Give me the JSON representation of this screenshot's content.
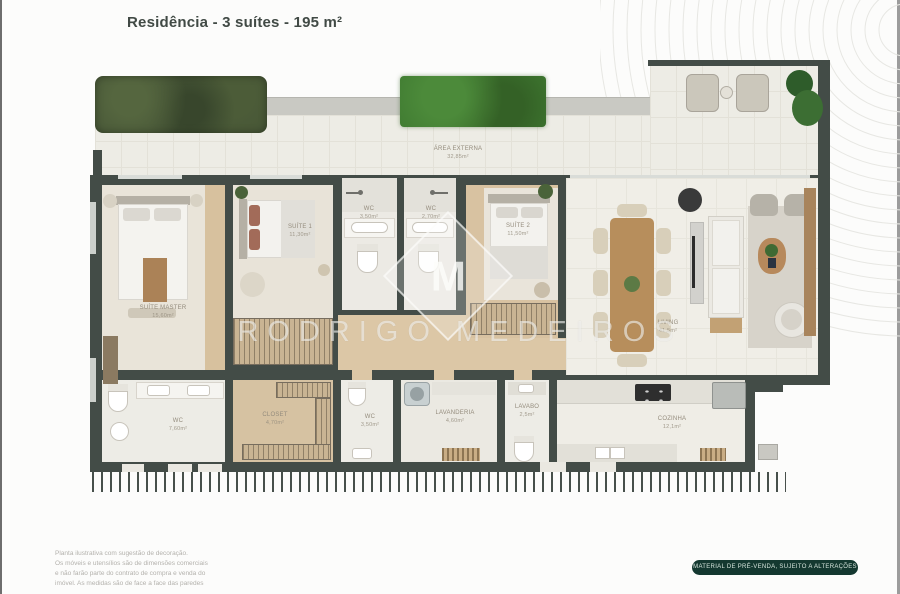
{
  "header": {
    "title": "Residência - 3 suítes - 195 m²"
  },
  "watermark": {
    "brand": "RODRIGO MEDEIROS",
    "monogram": "M"
  },
  "terrace": {
    "label": "ÁREA EXTERNA",
    "area": "32,85m²"
  },
  "rooms": {
    "suite_master": {
      "label": "SUÍTE MASTER",
      "area": "15,60m²"
    },
    "suite_1": {
      "label": "SUÍTE 1",
      "area": "11,30m²"
    },
    "wc_1": {
      "label": "WC",
      "area": "3,50m²"
    },
    "wc_2": {
      "label": "WC",
      "area": "2,70m²"
    },
    "suite_2": {
      "label": "SUÍTE 2",
      "area": "11,50m²"
    },
    "living": {
      "label": "LIVING",
      "area": "41,5m²"
    },
    "wc_master": {
      "label": "WC",
      "area": "7,60m²"
    },
    "closet": {
      "label": "CLOSET",
      "area": "4,70m²"
    },
    "wc_3": {
      "label": "WC",
      "area": "3,50m²"
    },
    "lavanderia": {
      "label": "LAVANDERIA",
      "area": "4,60m²"
    },
    "lavabo": {
      "label": "LAVABO",
      "area": "2,5m²"
    },
    "cozinha": {
      "label": "COZINHA",
      "area": "12,1m²"
    }
  },
  "footer": {
    "disclaimer_lines": [
      "Planta ilustrativa com sugestão de decoração.",
      "Os móveis e utensílios são de dimensões comerciais",
      "e não farão parte do contrato de compra e venda do",
      "imóvel. As medidas são de face a face das paredes"
    ],
    "badge": "MATERIAL DE PRÉ-VENDA, SUJEITO A ALTERAÇÕES"
  },
  "colors": {
    "wall": "#434c47",
    "badge_bg": "#143830",
    "wood": "#d7c19e",
    "grass": "#3f7a31"
  }
}
